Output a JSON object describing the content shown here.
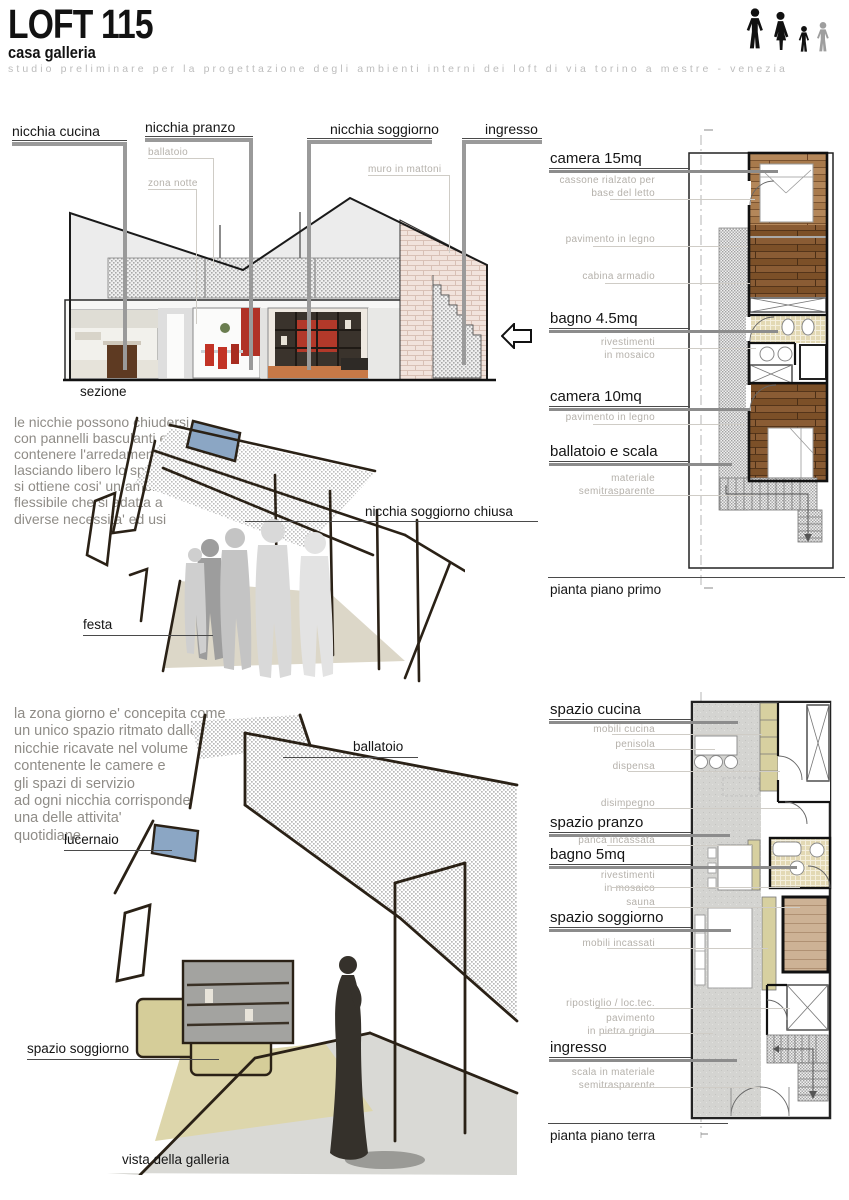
{
  "header": {
    "title": "LOFT 115",
    "subtitle": "casa galleria",
    "tagline": "studio preliminare per la progettazione degli ambienti interni dei loft di via torino a mestre - venezia",
    "family_icons": [
      {
        "name": "man-icon",
        "color": "#111111"
      },
      {
        "name": "woman-icon",
        "color": "#111111"
      },
      {
        "name": "boy-icon",
        "color": "#111111"
      },
      {
        "name": "boy-gray-icon",
        "color": "#9e9e9e"
      }
    ]
  },
  "section": {
    "caption": "sezione",
    "labels": [
      "nicchia cucina",
      "nicchia pranzo",
      "nicchia soggiorno",
      "ingresso"
    ],
    "sublabels": [
      "ballatoio",
      "zona notte",
      "muro in mattoni"
    ]
  },
  "study_flexible": {
    "paragraph": "le nicchie possono chiudersi\ncon pannelli basculanti e\ncontenere l'arredamento\nlasciando libero lo spazio\nsi ottiene cosi' un ambiente\nflessibile che si adatta a\ndiverse necessita' ed usi",
    "label_niche_closed": "nicchia soggiorno chiusa",
    "label_party": "festa"
  },
  "study_gallery": {
    "paragraph": "la zona giorno e' concepita come\nun unico spazio ritmato dalle\nnicchie ricavate nel volume\ncontenente le camere e\ngli spazi di servizio\nad ogni nicchia corrisponde\nuna delle attivita'\nquotidiane",
    "label_walkway": "ballatoio",
    "label_skylight": "lucernaio",
    "label_living": "spazio soggiorno",
    "caption": "vista della galleria"
  },
  "plan_first": {
    "caption": "pianta piano primo",
    "rooms": [
      "camera 15mq",
      "bagno 4.5mq",
      "camera 10mq",
      "ballatoio e scala"
    ],
    "notes": [
      "cassone rialzato per\nbase del letto",
      "pavimento in legno",
      "cabina armadio",
      "rivestimenti\nin mosaico",
      "pavimento in legno",
      "materiale\nsemitrasparente"
    ]
  },
  "plan_ground": {
    "caption": "pianta piano terra",
    "rooms": [
      "spazio cucina",
      "spazio pranzo",
      "bagno 5mq",
      "spazio soggiorno",
      "ingresso"
    ],
    "notes": [
      "mobili cucina",
      "penisola",
      "dispensa",
      "disimpegno",
      "panca incassata",
      "rivestimenti\nin mosaico",
      "sauna",
      "mobili incassati",
      "ripostiglio / loc.tec.",
      "pavimento\nin pietra grigia",
      "scala in materiale\nsemitrasparente"
    ]
  },
  "colors": {
    "ink": "#151515",
    "label_gray": "#b5b1ab",
    "leader_thick": "#8c8c8c",
    "leader_thin": "#cfccc6",
    "sketch_ink": "#2a2116",
    "wood": "#9a6a3e",
    "khaki": "#d7d0a0",
    "mosaic": "#e3d9b4",
    "sauna_wood": "#cdb295",
    "stone_floor": "#d4d4d1",
    "halftone": "#bdbdbd",
    "brick": "#f1e3dc",
    "accent_red": "#b83527",
    "sky_blue": "#8ba6c4"
  }
}
